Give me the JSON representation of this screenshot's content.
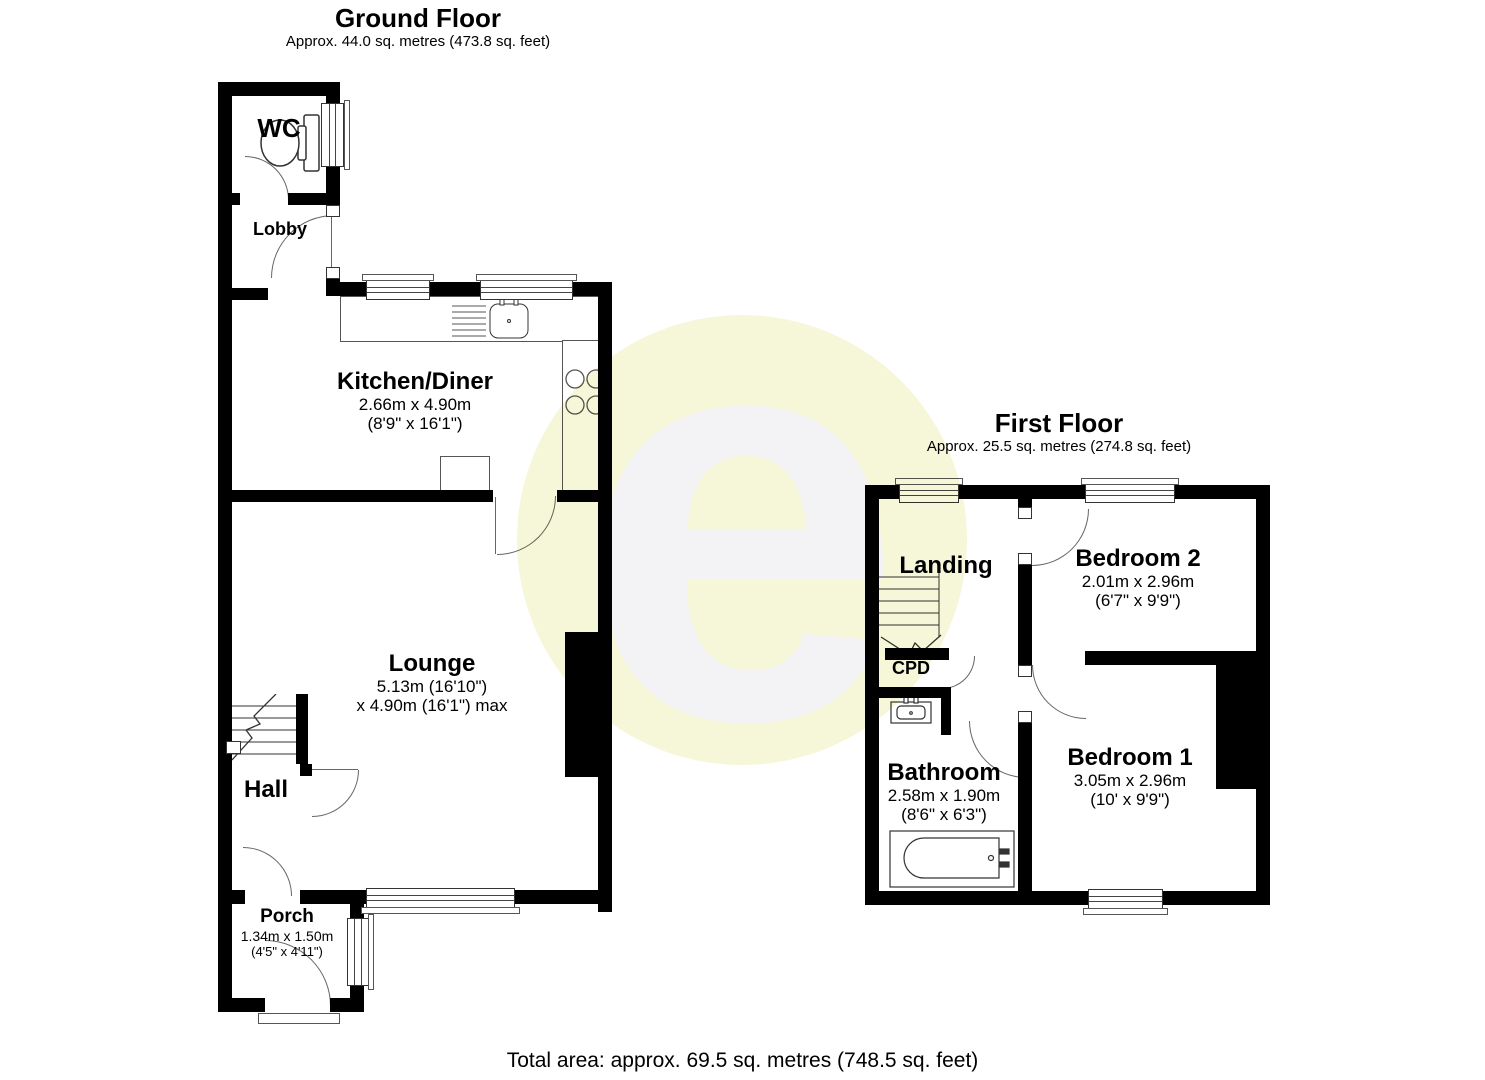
{
  "watermark": {
    "letter": "e"
  },
  "floors": [
    {
      "title": "Ground Floor",
      "subtitle": "Approx. 44.0 sq. metres (473.8 sq. feet)",
      "rooms": [
        {
          "name": "WC"
        },
        {
          "name": "Lobby"
        },
        {
          "name": "Kitchen/Diner",
          "dim1": "2.66m x 4.90m",
          "dim2": "(8'9\" x 16'1\")"
        },
        {
          "name": "Lounge",
          "dim1": "5.13m (16'10\")",
          "dim2": "x 4.90m (16'1\") max"
        },
        {
          "name": "Hall"
        },
        {
          "name": "Porch",
          "dim1": "1.34m x 1.50m",
          "dim2": "(4'5\" x 4'11\")"
        }
      ]
    },
    {
      "title": "First Floor",
      "subtitle": "Approx. 25.5 sq. metres (274.8 sq. feet)",
      "rooms": [
        {
          "name": "Landing"
        },
        {
          "name": "CPD"
        },
        {
          "name": "Bedroom 2",
          "dim1": "2.01m x 2.96m",
          "dim2": "(6'7\" x 9'9\")"
        },
        {
          "name": "Bathroom",
          "dim1": "2.58m x 1.90m",
          "dim2": "(8'6\" x 6'3\")"
        },
        {
          "name": "Bedroom 1",
          "dim1": "3.05m x 2.96m",
          "dim2": "(10' x 9'9\")"
        }
      ]
    }
  ],
  "footer": {
    "total_area": "Total area: approx. 69.5 sq. metres (748.5 sq. feet)"
  }
}
